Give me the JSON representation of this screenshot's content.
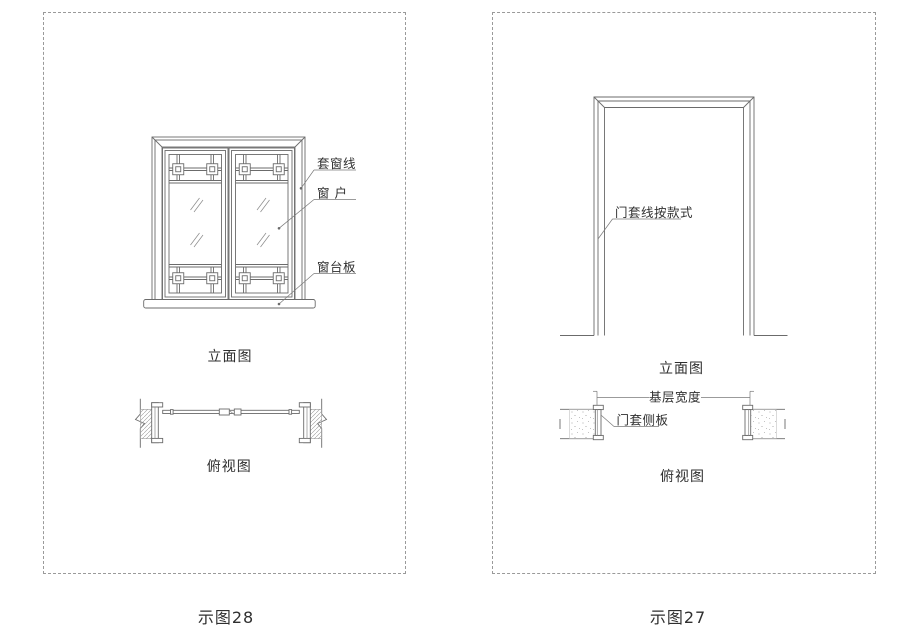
{
  "colors": {
    "line": "#6b6b6b",
    "text": "#2f2f2f",
    "dashed_border": "#9a9a9a"
  },
  "left_panel": {
    "figure_label": "示图28",
    "elevation": {
      "caption": "立面图",
      "labels": {
        "casing_line": "套窗线",
        "window": "窗 户",
        "sill_board": "窗台板"
      }
    },
    "plan": {
      "caption": "俯视图"
    }
  },
  "right_panel": {
    "figure_label": "示图27",
    "elevation": {
      "caption": "立面图",
      "labels": {
        "casing_style": "门套线按款式"
      }
    },
    "plan": {
      "caption": "俯视图",
      "labels": {
        "base_width": "基层宽度",
        "side_panel": "门套侧板"
      }
    }
  }
}
